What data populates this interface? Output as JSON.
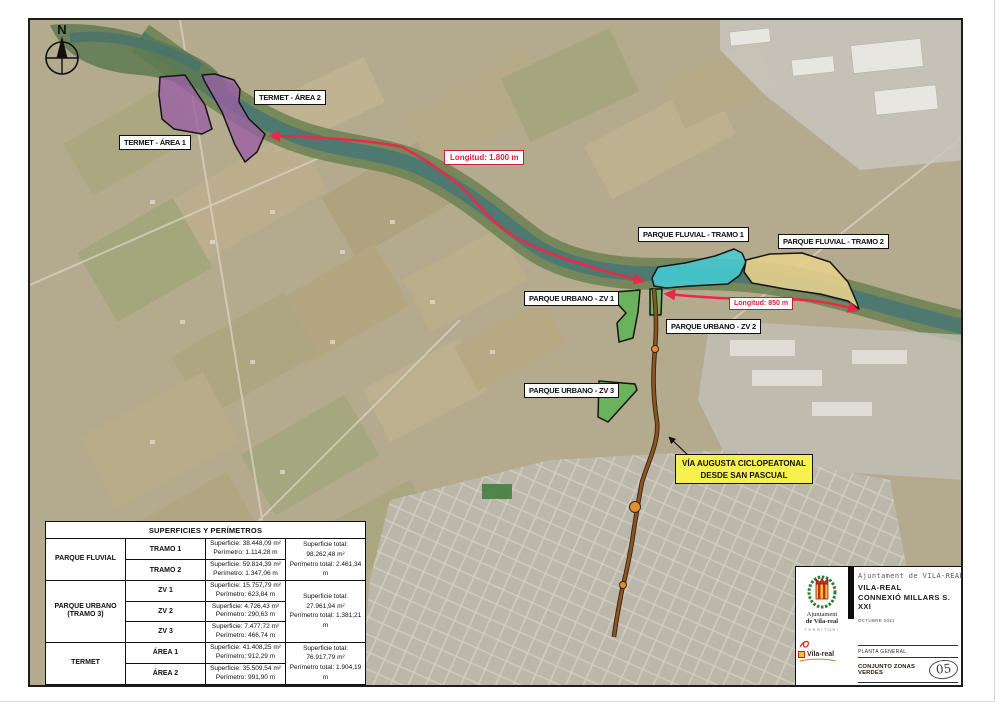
{
  "compass": {
    "label": "N"
  },
  "zones": [
    {
      "id": "termet-area-1",
      "label": "TERMET - ÁREA 1",
      "color": "#9a5fa5"
    },
    {
      "id": "termet-area-2",
      "label": "TERMET - ÁREA 2",
      "color": "#9a5fa5"
    },
    {
      "id": "parque-fluvial-tramo-1",
      "label": "PARQUE FLUVIAL - TRAMO 1",
      "color": "#43cdd6"
    },
    {
      "id": "parque-fluvial-tramo-2",
      "label": "PARQUE FLUVIAL - TRAMO 2",
      "color": "#e5cf8e"
    },
    {
      "id": "parque-urbano-zv-1",
      "label": "PARQUE URBANO - ZV 1",
      "color": "#5db554"
    },
    {
      "id": "parque-urbano-zv-2",
      "label": "PARQUE URBANO - ZV 2",
      "color": "#5db554"
    },
    {
      "id": "parque-urbano-zv-3",
      "label": "PARQUE URBANO - ZV 3",
      "color": "#5db554"
    }
  ],
  "annotations": {
    "longitud_1800": "Longitud: 1.800 m",
    "longitud_850": "Longitud: 850 m",
    "via_augusta": {
      "line1": "VÍA AUGUSTA CICLOPEATONAL",
      "line2": "DESDE SAN PASCUAL"
    }
  },
  "table": {
    "title": "SUPERFICIES Y PERÍMETROS",
    "groups": [
      {
        "name": "PARQUE FLUVIAL",
        "name2": "",
        "rows": [
          {
            "label": "TRAMO 1",
            "superficie": "Superficie: 38.448,09 m²",
            "perimetro": "Perímetro: 1.114,28 m"
          },
          {
            "label": "TRAMO 2",
            "superficie": "Superficie: 59.814,39 m²",
            "perimetro": "Perímetro: 1.347,06 m"
          }
        ],
        "superficie_total": "Superficie total: 98.262,48 m²",
        "perimetro_total": "Perímetro total: 2.461,34 m"
      },
      {
        "name": "PARQUE URBANO",
        "name2": "(TRAMO 3)",
        "rows": [
          {
            "label": "ZV 1",
            "superficie": "Superficie: 15.757,79 m²",
            "perimetro": "Perímetro: 623,84 m"
          },
          {
            "label": "ZV 2",
            "superficie": "Superficie: 4.726,43 m²",
            "perimetro": "Perímetro: 290,63 m"
          },
          {
            "label": "ZV 3",
            "superficie": "Superficie: 7.477,72 m²",
            "perimetro": "Perímetro: 466,74 m"
          }
        ],
        "superficie_total": "Superficie total: 27.961,94 m²",
        "perimetro_total": "Perímetro total: 1.381,21 m"
      },
      {
        "name": "TERMET",
        "name2": "",
        "rows": [
          {
            "label": "ÁREA 1",
            "superficie": "Superficie: 41.408,25 m²",
            "perimetro": "Perímetro: 912,29 m"
          },
          {
            "label": "ÁREA 2",
            "superficie": "Superficie: 35.509,54 m²",
            "perimetro": "Perímetro: 991,90 m"
          }
        ],
        "superficie_total": "Superficie total: 76.917,79 m²",
        "perimetro_total": "Perímetro total: 1.904,19 m"
      }
    ]
  },
  "title_block": {
    "org_header": "Ajuntament de VILA-REAL",
    "project_line1": "VILA-REAL",
    "project_line2": "CONNEXIÓ MILLARS S. XXI",
    "date": "OCTUBRE 2021",
    "plan_type": "PLANTA GENERAL",
    "plan_title": "CONJUNTO ZONAS VERDES",
    "sheet_number": "05",
    "scale": "E 1:10000",
    "logo": {
      "line1": "Ajuntament",
      "line2": "de Vila-real",
      "line3": "TERRITORI",
      "brand": "Vila-real"
    }
  },
  "colors": {
    "route_red": "#e8294a",
    "path_brown": "#7a4a1f",
    "node_orange": "#e2902f",
    "termet_purple": "#9a5fa5",
    "fluvial_cyan": "#43cdd6",
    "fluvial_tan": "#e5cf8e",
    "urbano_green": "#5db554",
    "annotation_yellow": "#f6f14e"
  }
}
